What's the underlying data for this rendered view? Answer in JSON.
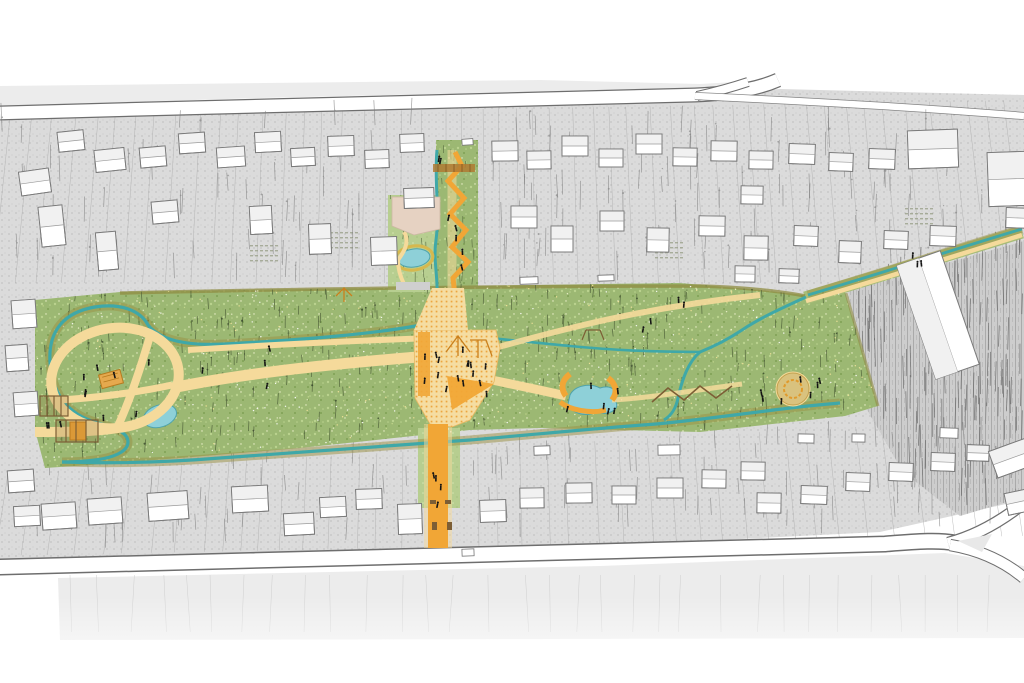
{
  "title": "Illustrated axonometric site plan of a linear neighborhood park",
  "colors": {
    "bg": "#ffffff",
    "aboveRoad": "#e9e9e9",
    "fabricBase": "#dbdbdb",
    "fabricDot": "#c3c3c3",
    "lotLine": "#a5a5a5",
    "darkZoneBase": "#cccccc",
    "darkZoneLine": "#989898",
    "roadEdge": "#6e6e6e",
    "roadFill": "#ffffff",
    "belowRoad": "#ececec",
    "buildingFill": "#ffffff",
    "buildingShade": "#f1f1f1",
    "buildingStroke": "#7a7a7a",
    "meadowBase": "#9cb873",
    "meadowLight": "#bad28e",
    "meadowDark": "#7fa055",
    "meadowSpeck": "#eef2cd",
    "lawnLight": "#b7ce90",
    "treeDark": "#53653c",
    "treeGray": "#7b7b7b",
    "treeDarkZone": "#666666",
    "oliveBand": "#9a9044",
    "hedge": "#8f8c42",
    "stream": "#3fa8a8",
    "pond": "#8ed0d8",
    "pondStroke": "#4fa3ab",
    "pathPale": "#f5da9b",
    "pathEdge": "#e3ba62",
    "orange": "#f1a636",
    "orangeDeep": "#c9801d",
    "plazaBase": "#f5dda2",
    "plazaDot": "#eca63f",
    "tan": "#e6d2c2",
    "brown": "#7c5e35",
    "people": "#141414"
  },
  "features": [
    "linear-park-meadow",
    "west-loop-path",
    "west-pond",
    "central-plaza-playground",
    "north-entry-corridor",
    "pocket-garden-pond",
    "main-north-south-path",
    "south-entry-path",
    "meandering-creek",
    "central-pond",
    "east-play-mound",
    "zigzag-boardwalk",
    "northeast-greenway",
    "perimeter-streets",
    "residential-blocks",
    "pedestrians"
  ]
}
